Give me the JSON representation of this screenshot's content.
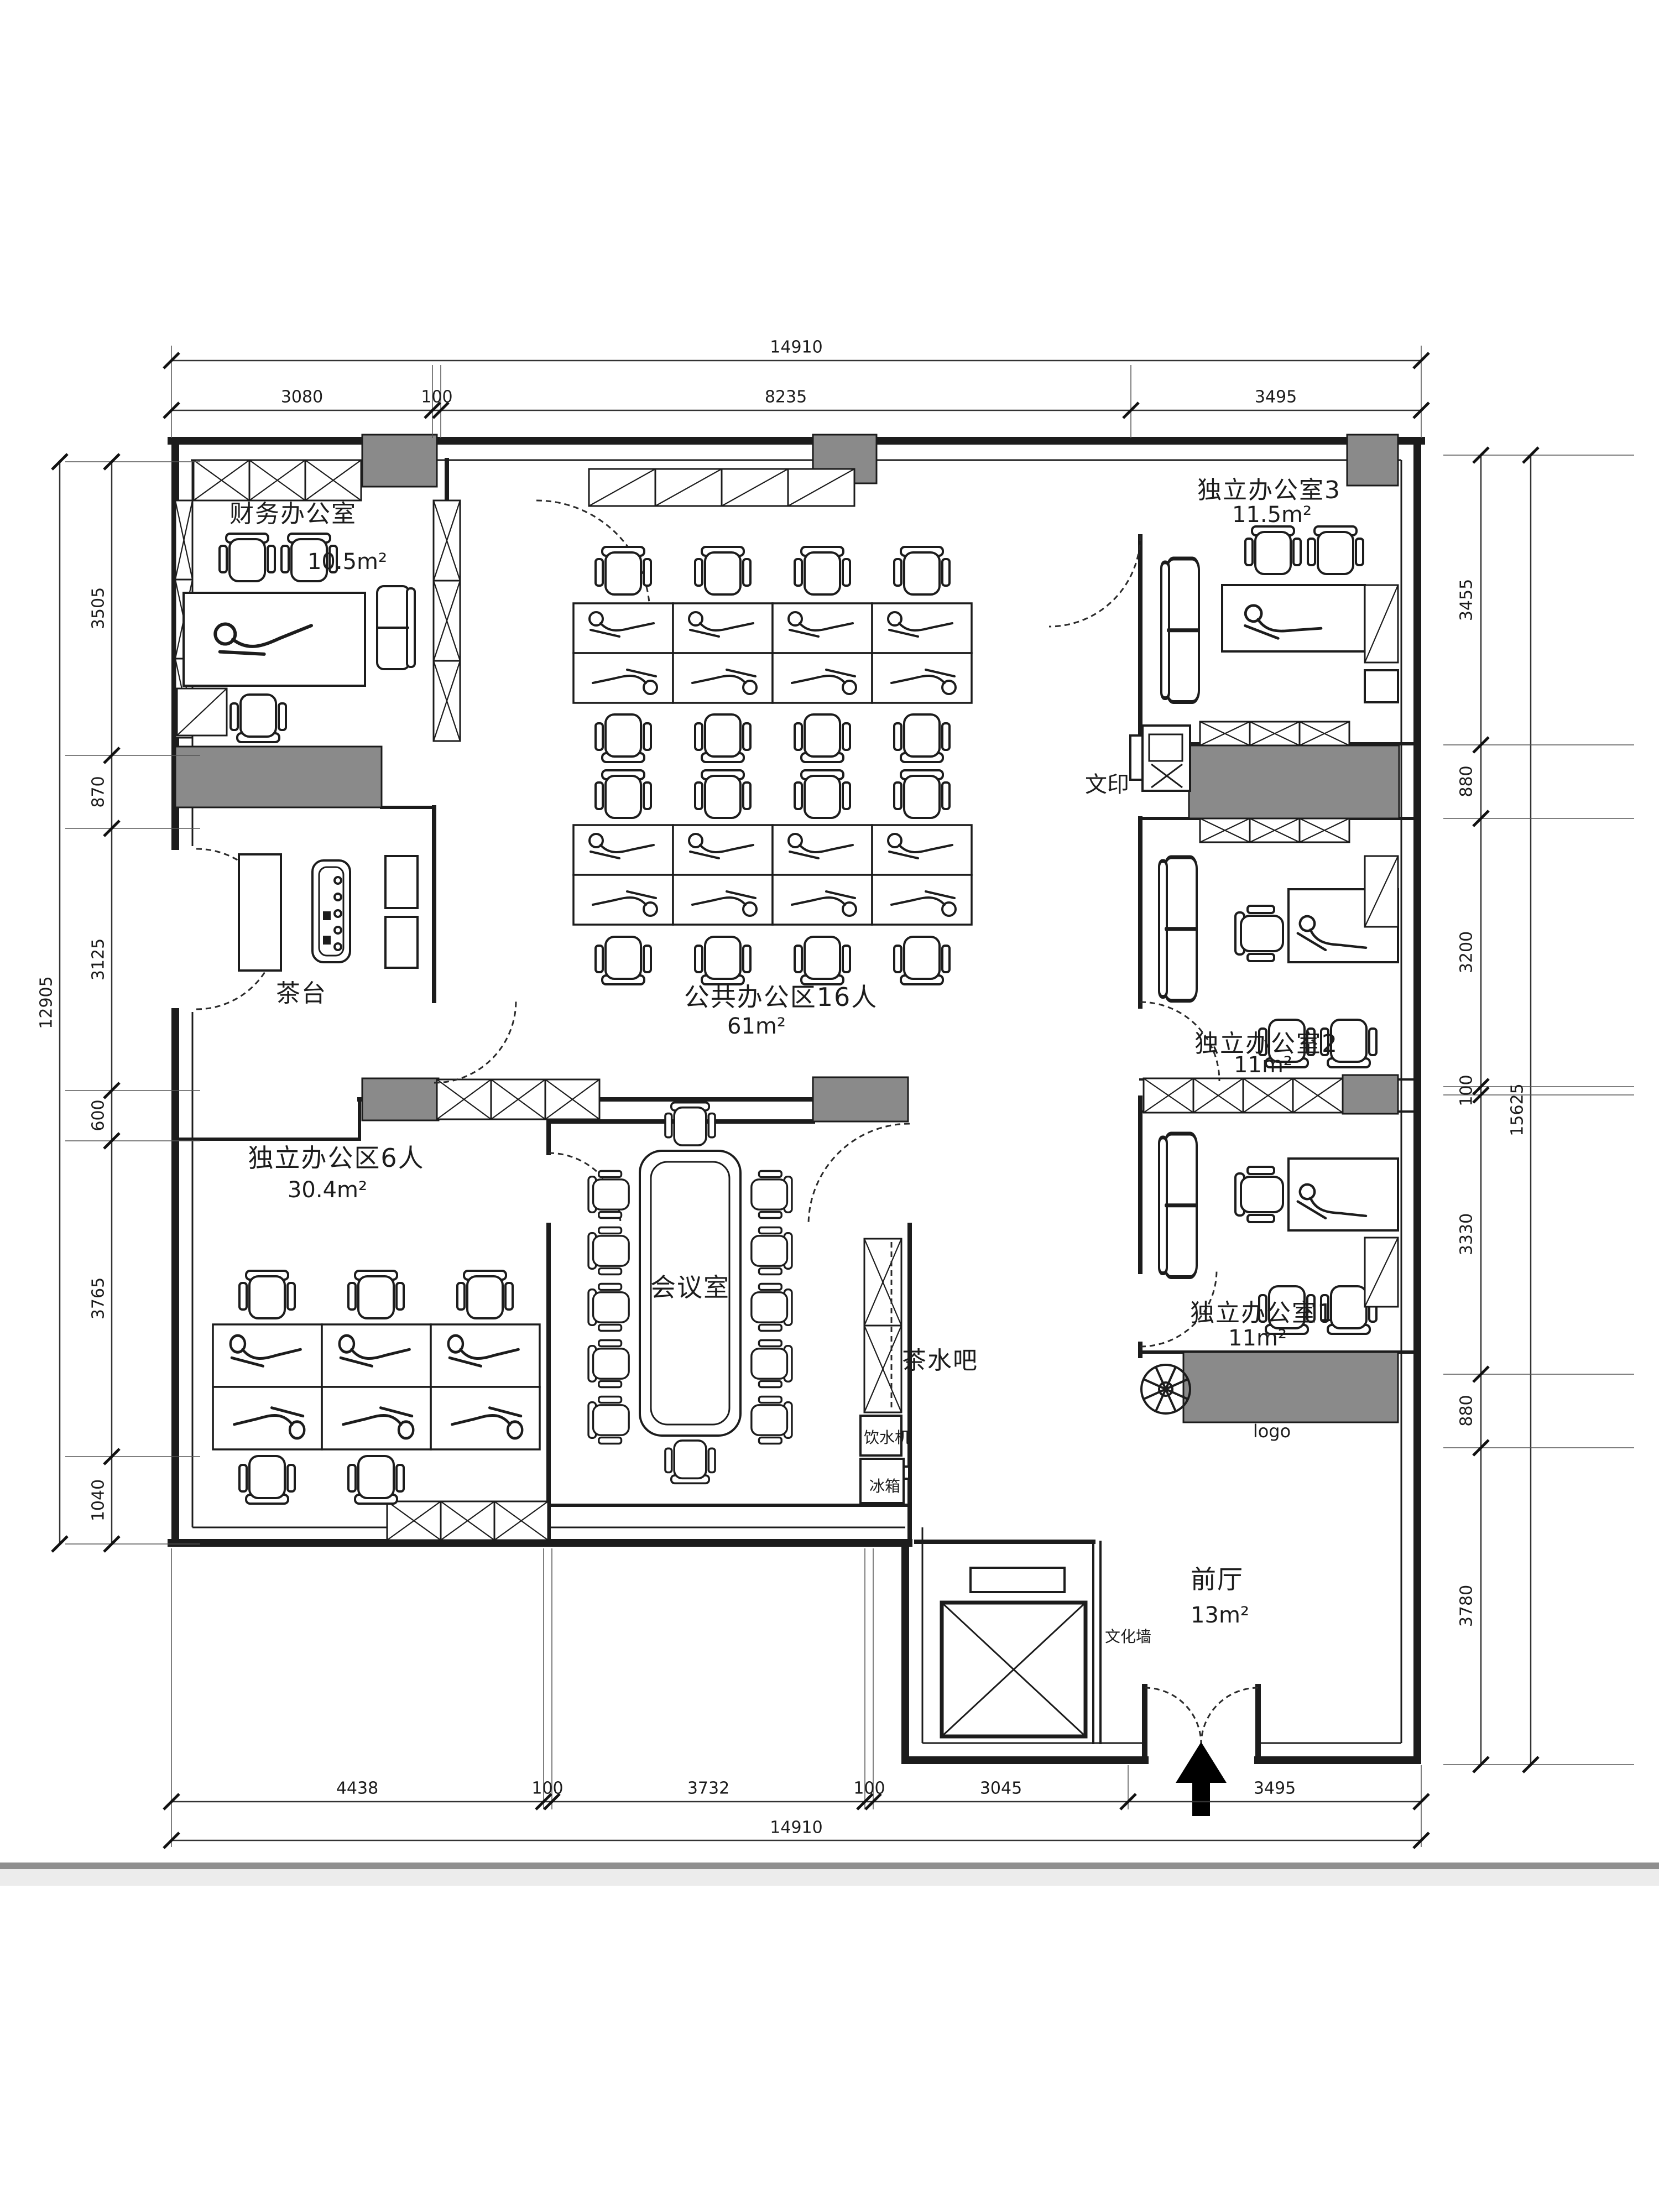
{
  "drawing": {
    "type": "office floor plan"
  },
  "rooms": {
    "finance": {
      "name": "财务办公室",
      "area": "10.5m²"
    },
    "office3": {
      "name": "独立办公室3",
      "area": "11.5m²"
    },
    "public": {
      "name": "公共办公区16人",
      "area": "61m²"
    },
    "zone6": {
      "name": "独立办公区6人",
      "area": "30.4m²"
    },
    "meeting": {
      "name": "会议室"
    },
    "office2": {
      "name": "独立办公室2",
      "area": "11m²"
    },
    "office1": {
      "name": "独立办公室1",
      "area": "11m²"
    },
    "lobby": {
      "name": "前厅",
      "area": "13m²"
    }
  },
  "labels": {
    "print": "文印",
    "tea_table": "茶台",
    "tea_bar": "茶水吧",
    "water_dispenser": "饮水机",
    "fridge": "冰箱",
    "culture_wall": "文化墙",
    "logo": "logo"
  },
  "dimensions": {
    "top": {
      "total": "14910",
      "segments": [
        "3080",
        "100",
        "8235",
        "3495"
      ]
    },
    "bottom": {
      "total": "14910",
      "segments": [
        "4438",
        "100",
        "3732",
        "100",
        "3045",
        "3495"
      ]
    },
    "left": {
      "total": "12905",
      "segments": [
        "3505",
        "870",
        "3125",
        "600",
        "3765",
        "1040"
      ]
    },
    "right": {
      "total": "15625",
      "segments": [
        "3455",
        "880",
        "3200",
        "100",
        "3330",
        "880",
        "3780"
      ]
    }
  },
  "colors": {
    "ink": "#1c1c1c",
    "column_fill": "#8a8a8a",
    "paper": "#ffffff"
  }
}
